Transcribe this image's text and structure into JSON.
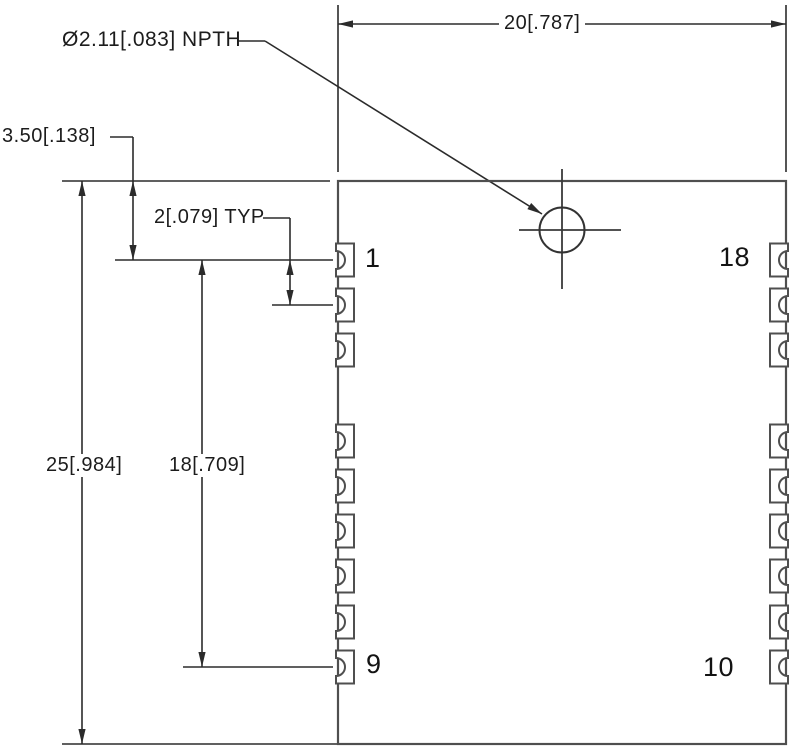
{
  "drawing": {
    "type": "pcb-module-footprint-mechanical-drawing",
    "units": "mm [inches]",
    "labels": {
      "hole_callout": "Ø2.11[.083] NPTH",
      "width_dim": "20[.787]",
      "overall_height_dim": "25[.984]",
      "pin_span_dim": "18[.709]",
      "pin1_offset_dim": "3.50[.138]",
      "pitch_dim": "2[.079] TYP"
    },
    "pins": {
      "left_top": "1",
      "left_bottom": "9",
      "right_top": "18",
      "right_bottom": "10"
    },
    "colors": {
      "background": "#ffffff",
      "outline_gray": "#4f4f4f",
      "dimension_dark": "#2b2b2b",
      "text": "#1c1c1c"
    },
    "geometry": {
      "module": {
        "x": 338,
        "y": 181,
        "w": 448,
        "h": 563
      },
      "pad": {
        "half_h": 16.5,
        "depth": 18,
        "notch_r": 9
      },
      "pad_centers_y": [
        260,
        305,
        350,
        441,
        486,
        531,
        576,
        622,
        667
      ],
      "hole": {
        "cx": 562,
        "cy": 230,
        "r": 22.5,
        "cross_h_x1": 519,
        "cross_h_x2": 621,
        "cross_v_y1": 169,
        "cross_v_y2": 289
      },
      "lines": [
        [
          338,
          24,
          786,
          24
        ],
        [
          338,
          5,
          338,
          172
        ],
        [
          786,
          5,
          786,
          172
        ],
        [
          62,
          181,
          330,
          181
        ],
        [
          62,
          744,
          338,
          744
        ],
        [
          82,
          181,
          82,
          744
        ],
        [
          110,
          137,
          133,
          137
        ],
        [
          133,
          137,
          133,
          260
        ],
        [
          202,
          260,
          202,
          667
        ],
        [
          115,
          260,
          333,
          260
        ],
        [
          272,
          305,
          333,
          305
        ],
        [
          183,
          667,
          333,
          667
        ],
        [
          263,
          218,
          290,
          218
        ],
        [
          290,
          218,
          290,
          305
        ],
        [
          237,
          41,
          265,
          41
        ],
        [
          265,
          41,
          542,
          214
        ]
      ],
      "crosshair_lines": [
        [
          519,
          230,
          621,
          230
        ],
        [
          562,
          169,
          562,
          289
        ]
      ],
      "arrows": [
        {
          "x": 338,
          "y": 24,
          "angle": 180
        },
        {
          "x": 786,
          "y": 24,
          "angle": 0
        },
        {
          "x": 82,
          "y": 181,
          "angle": -90
        },
        {
          "x": 82,
          "y": 744,
          "angle": 90
        },
        {
          "x": 133,
          "y": 181,
          "angle": -90
        },
        {
          "x": 133,
          "y": 260,
          "angle": 90
        },
        {
          "x": 202,
          "y": 260,
          "angle": -90
        },
        {
          "x": 202,
          "y": 667,
          "angle": 90
        },
        {
          "x": 290,
          "y": 260,
          "angle": -90
        },
        {
          "x": 290,
          "y": 305,
          "angle": 90
        },
        {
          "x": 542,
          "y": 214,
          "angle": 32
        }
      ]
    }
  }
}
